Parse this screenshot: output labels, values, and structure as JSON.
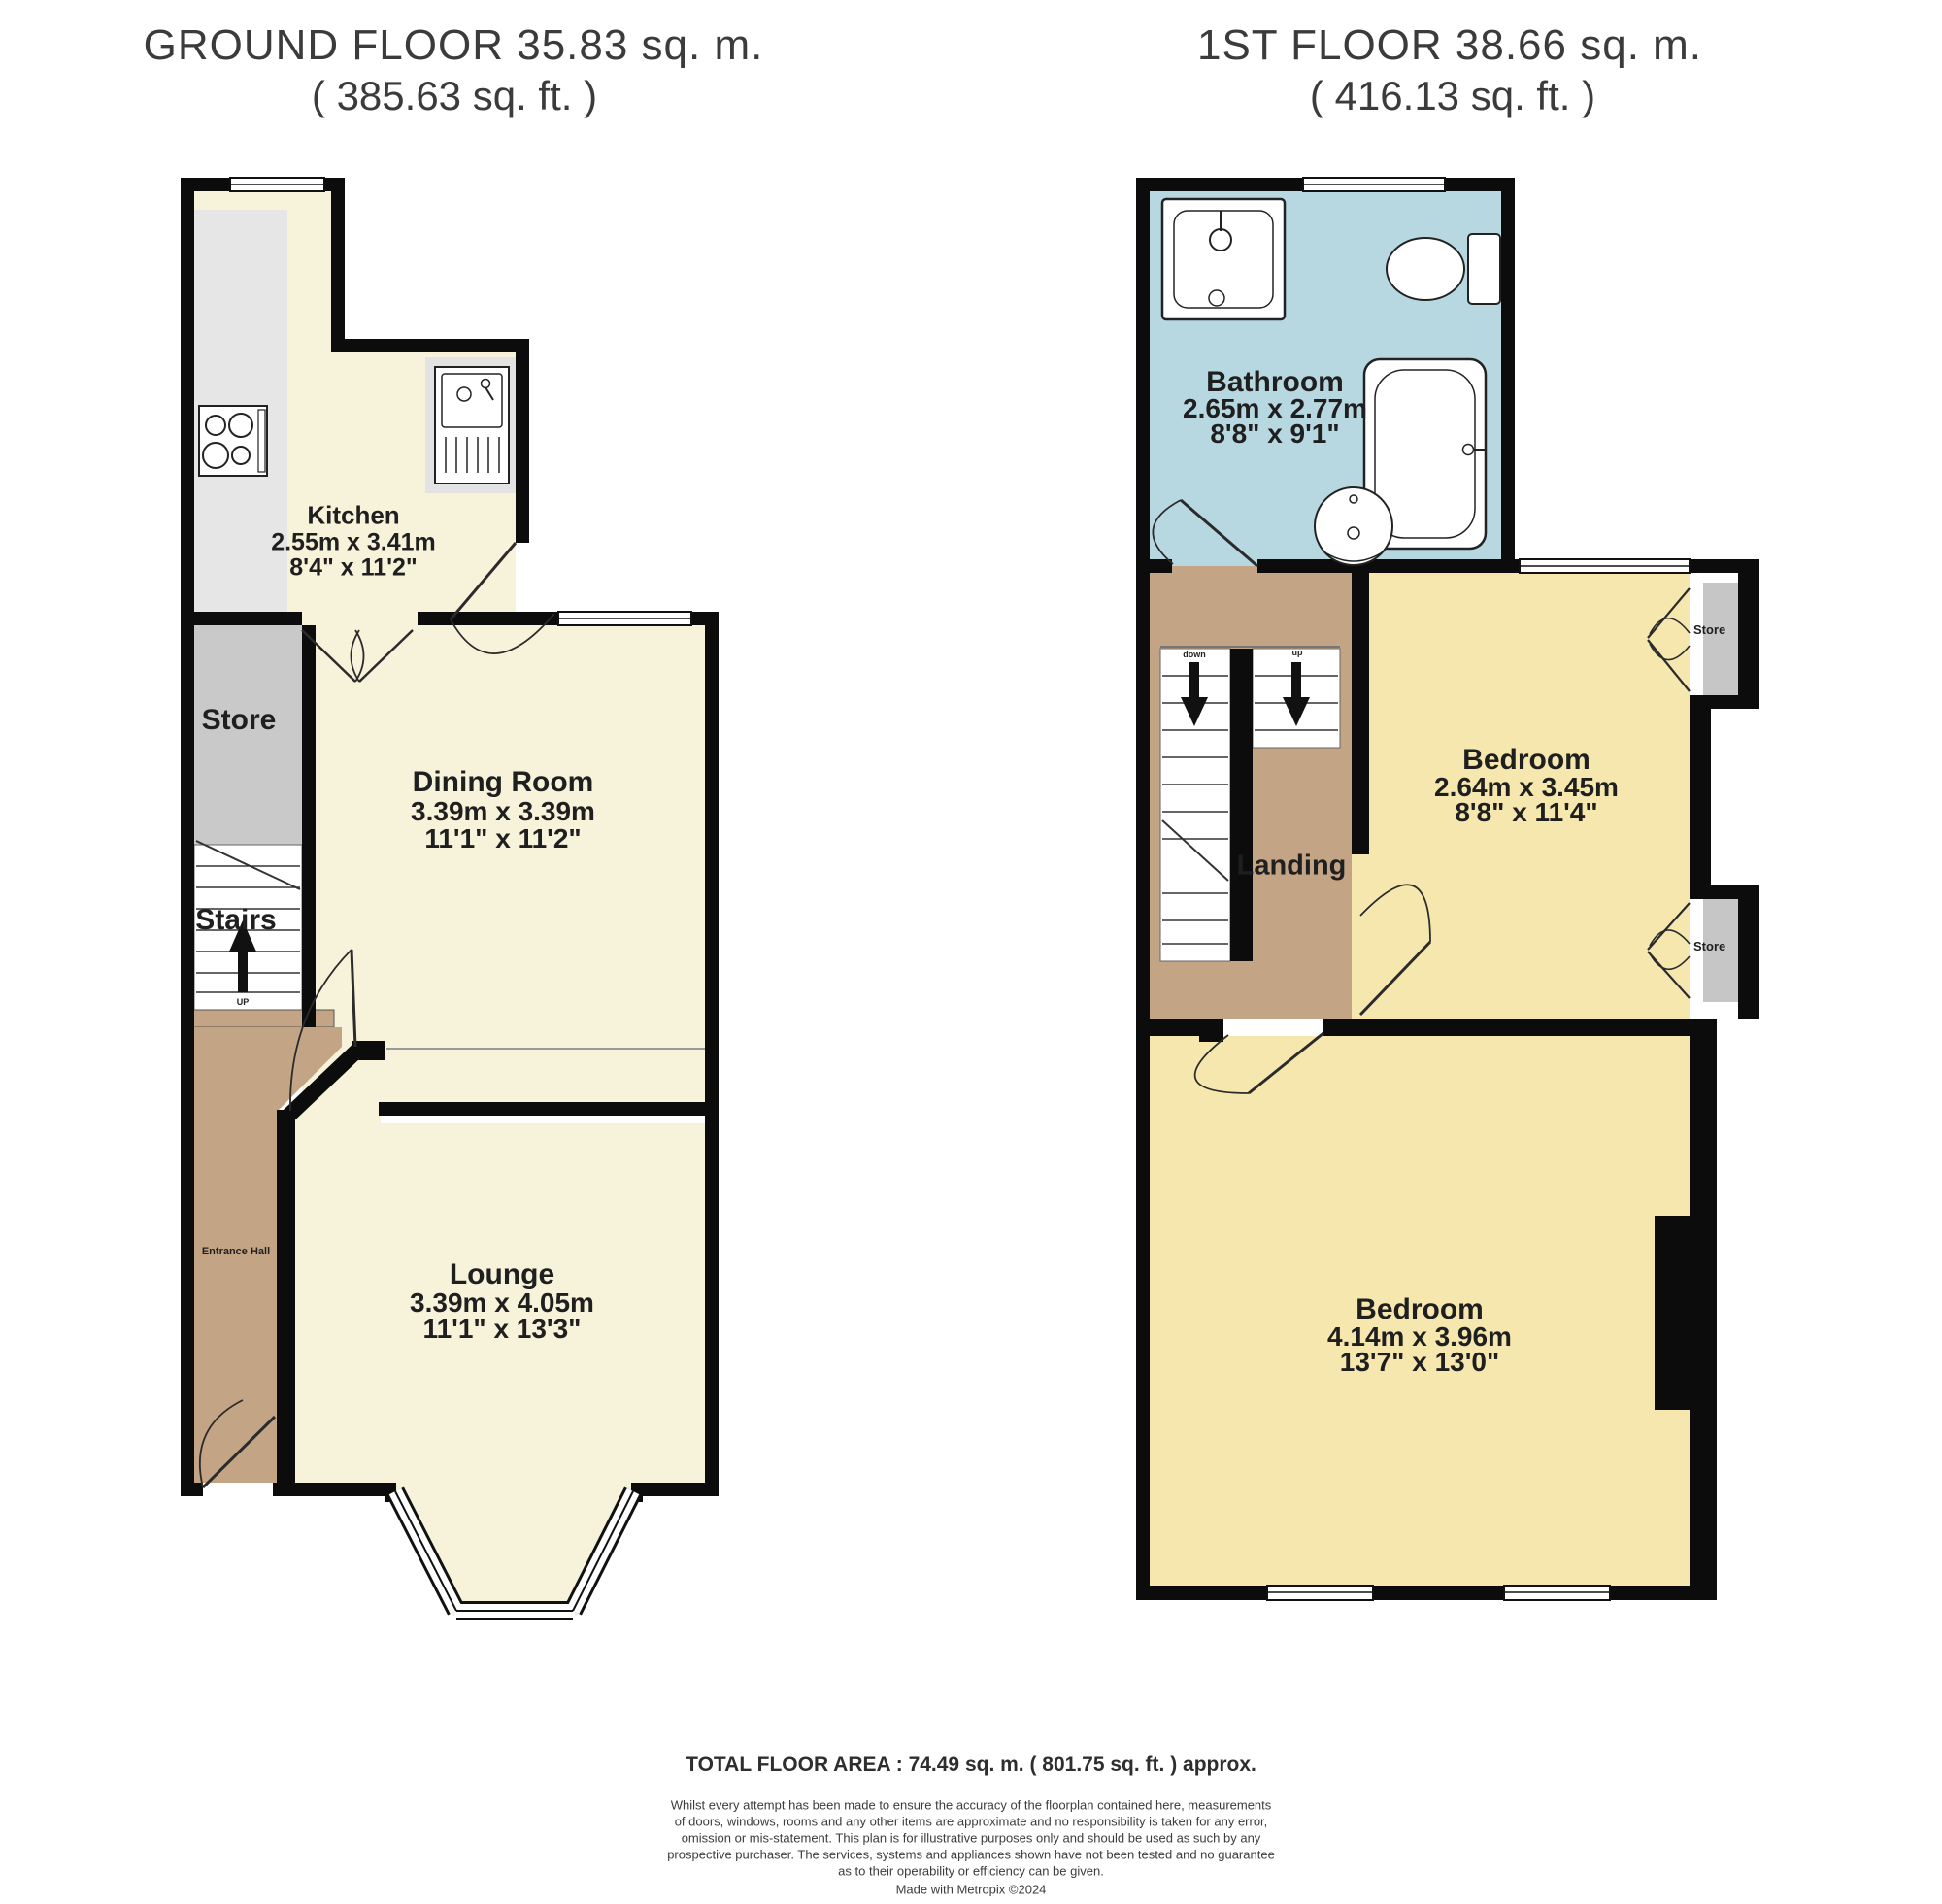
{
  "ground_floor": {
    "title": "GROUND FLOOR 35.83 sq. m.",
    "subtitle": "( 385.63 sq. ft. )",
    "kitchen": {
      "name": "Kitchen",
      "dims_metric": "2.55m x 3.41m",
      "dims_imperial": "8'4\" x 11'2\""
    },
    "dining": {
      "name": "Dining Room",
      "dims_metric": "3.39m x 3.39m",
      "dims_imperial": "11'1\" x 11'2\""
    },
    "lounge": {
      "name": "Lounge",
      "dims_metric": "3.39m x 4.05m",
      "dims_imperial": "11'1\" x 13'3\""
    },
    "store": {
      "name": "Store"
    },
    "stairs": {
      "name": "Stairs",
      "direction": "UP"
    },
    "entrance_hall": {
      "name": "Entrance Hall"
    }
  },
  "first_floor": {
    "title": "1ST FLOOR 38.66 sq. m.",
    "subtitle": "( 416.13 sq. ft. )",
    "bathroom": {
      "name": "Bathroom",
      "dims_metric": "2.65m x 2.77m",
      "dims_imperial": "8'8\" x 9'1\""
    },
    "bedroom1": {
      "name": "Bedroom",
      "dims_metric": "2.64m x 3.45m",
      "dims_imperial": "8'8\" x 11'4\""
    },
    "bedroom2": {
      "name": "Bedroom",
      "dims_metric": "4.14m x 3.96m",
      "dims_imperial": "13'7\" x 13'0\""
    },
    "landing": {
      "name": "Landing"
    },
    "store_top": {
      "name": "Store"
    },
    "store_bottom": {
      "name": "Store"
    },
    "stairs": {
      "down_label": "down",
      "up_label": "up"
    }
  },
  "footer": {
    "total": "TOTAL FLOOR AREA : 74.49 sq. m. ( 801.75 sq. ft. ) approx.",
    "disclaimer": [
      "Whilst every attempt has been made to ensure the accuracy of the floorplan contained here, measurements",
      "of doors, windows, rooms and any other items are approximate and no responsibility is taken for any error,",
      "omission or mis-statement. This plan is for illustrative purposes only and should be used as such by any",
      "prospective purchaser. The services, systems and appliances shown have not been tested and no guarantee",
      "as to their operability or efficiency can be given."
    ],
    "credit": "Made with Metropix ©2024"
  },
  "colors": {
    "room_cream": "#f7f2da",
    "room_yellow": "#f5e7ae",
    "bathroom_blue": "#b7d8e1",
    "hall_brown": "#c3a484",
    "store_grey": "#c9c9c9",
    "counter_grey": "#e6e6e6",
    "wall_black": "#0c0c0c"
  }
}
